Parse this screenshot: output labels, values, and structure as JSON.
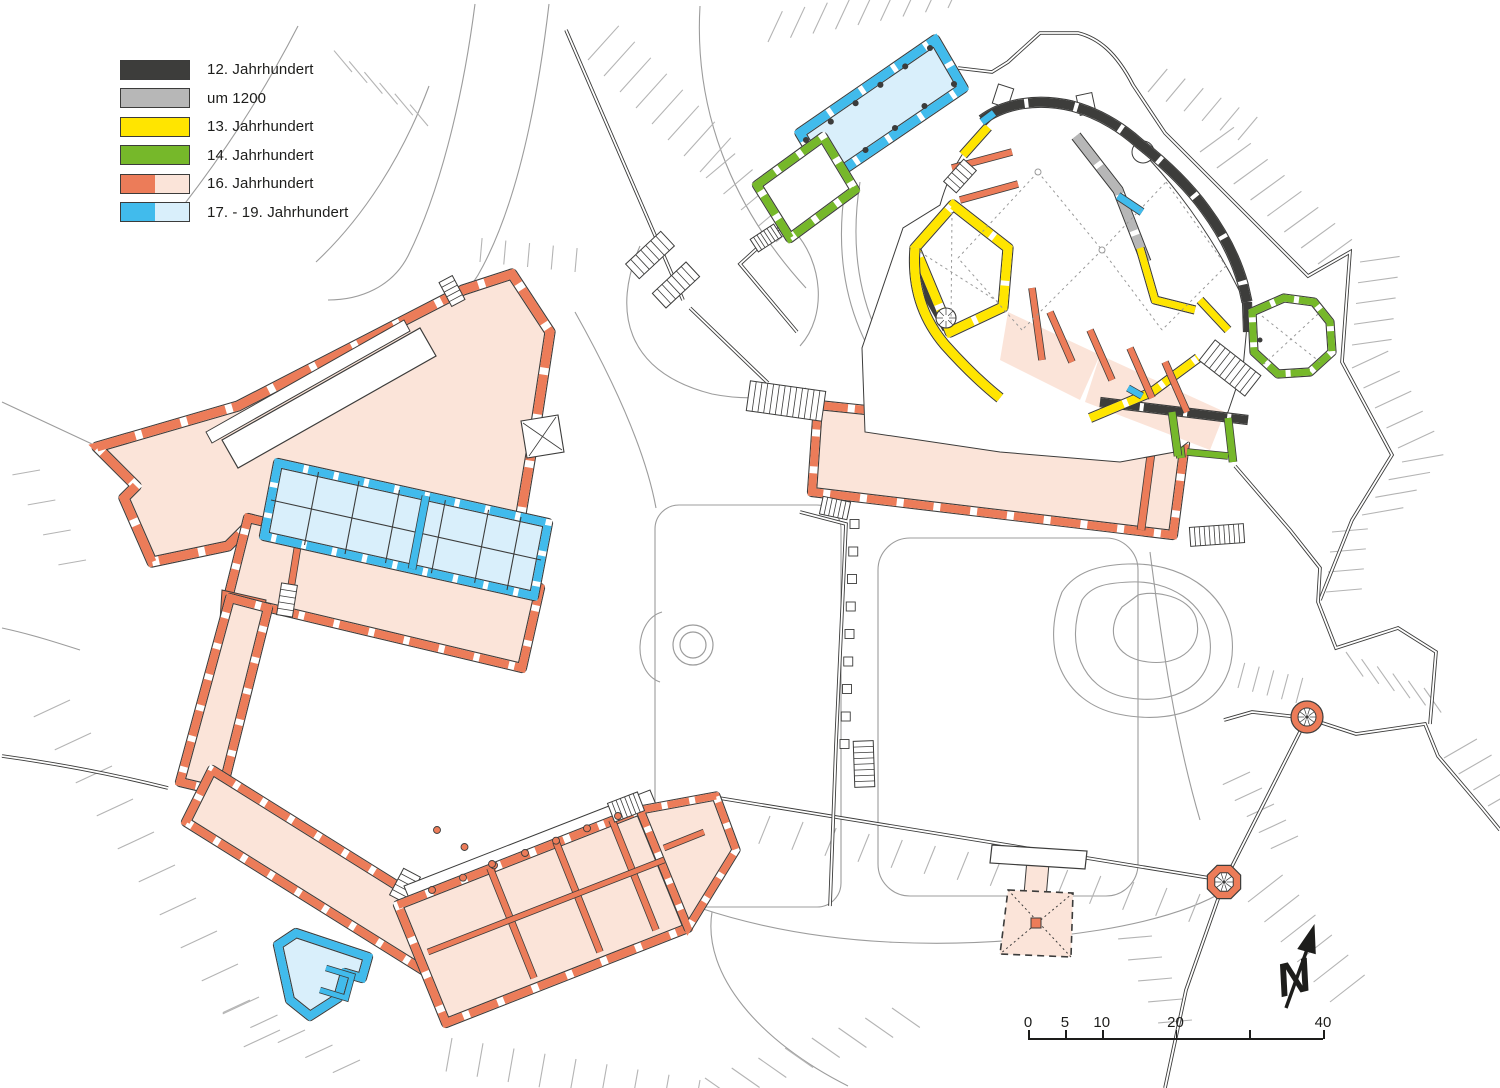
{
  "legend": {
    "items": [
      {
        "label": "12. Jahrhundert",
        "colors": [
          "#3d3d3b"
        ]
      },
      {
        "label": "um 1200",
        "colors": [
          "#b7b7b7"
        ]
      },
      {
        "label": "13. Jahrhundert",
        "colors": [
          "#ffe500"
        ]
      },
      {
        "label": "14. Jahrhundert",
        "colors": [
          "#76b82a"
        ]
      },
      {
        "label": "16. Jahrhundert",
        "colors": [
          "#ec7c59",
          "#fbe4d9"
        ]
      },
      {
        "label": "17. - 19. Jahrhundert",
        "colors": [
          "#41bbec",
          "#d9effb"
        ]
      }
    ]
  },
  "scale_bar": {
    "max": 40,
    "ticks": [
      {
        "value": 0,
        "label": "0"
      },
      {
        "value": 5,
        "label": "5"
      },
      {
        "value": 10,
        "label": "10"
      },
      {
        "value": 20,
        "label": "20"
      },
      {
        "value": 30,
        "label": ""
      },
      {
        "value": 40,
        "label": "40"
      }
    ]
  },
  "north_indicator": {
    "label": "N"
  },
  "map": {
    "colors": {
      "phase_12c": "#3d3d3b",
      "phase_1200": "#b7b7b7",
      "phase_13c": "#ffe500",
      "phase_14c": "#76b82a",
      "phase_16c_wall": "#ec7c59",
      "phase_16c_fill": "#fbe4d9",
      "phase_17_19c_wall": "#41bbec",
      "phase_17_19c_fill": "#d9effb",
      "outline": "#3c3c3b",
      "path_line": "#9c9c9c",
      "hatch": "#b4b4b4",
      "decor_dash": "#999999"
    }
  }
}
